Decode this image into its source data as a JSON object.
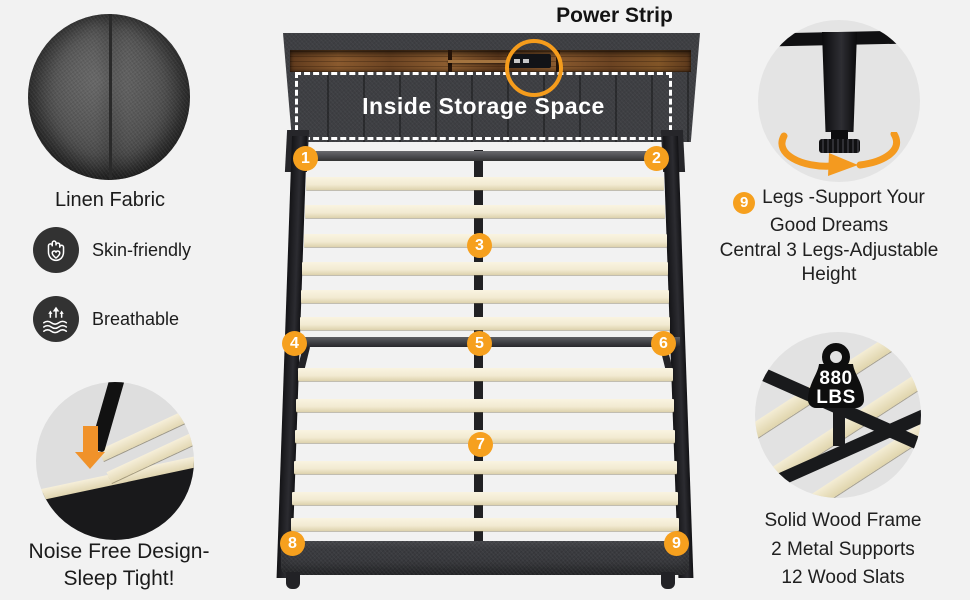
{
  "title": {
    "power_strip": "Power Strip"
  },
  "headboard": {
    "storage": "Inside Storage Space"
  },
  "left_column": {
    "fabric_label": "Linen Fabric",
    "features": [
      {
        "icon": "hand-heart-icon",
        "label": "Skin-friendly"
      },
      {
        "icon": "breathable-waves-icon",
        "label": "Breathable"
      }
    ],
    "noise_line1": "Noise Free Design-",
    "noise_line2": "Sleep Tight!"
  },
  "right_column": {
    "legs_badge": "9",
    "legs_line1": "Legs -Support Your",
    "legs_line2": "Good Dreams",
    "legs_line3": "Central 3 Legs-Adjustable",
    "legs_line4": "Height",
    "weight_value": "880",
    "weight_unit": "LBS",
    "frame_line1": "Solid Wood Frame",
    "frame_line2": "2 Metal Supports",
    "frame_line3": "12 Wood Slats"
  },
  "markers": [
    "1",
    "2",
    "3",
    "4",
    "5",
    "6",
    "7",
    "8",
    "9"
  ],
  "icons": {
    "feature_1": "hand-heart-icon",
    "feature_2": "breathable-waves-icon",
    "noise_arrow": "down-arrow-icon",
    "leg_rotation": "rotate-arrows-icon",
    "weight": "weight-icon",
    "power_highlight": "highlight-circle-icon"
  },
  "colors": {
    "background": "#f2f2f2",
    "accent_orange": "#f6a01e",
    "arrow_orange": "#ef8f27",
    "icon_circle_dark": "#323232",
    "slat_cream": "#f5eed8",
    "frame_black": "#1d1e21",
    "wood_brown": "#7c4e27",
    "text_dark": "#1c1c1c",
    "white": "#ffffff"
  }
}
